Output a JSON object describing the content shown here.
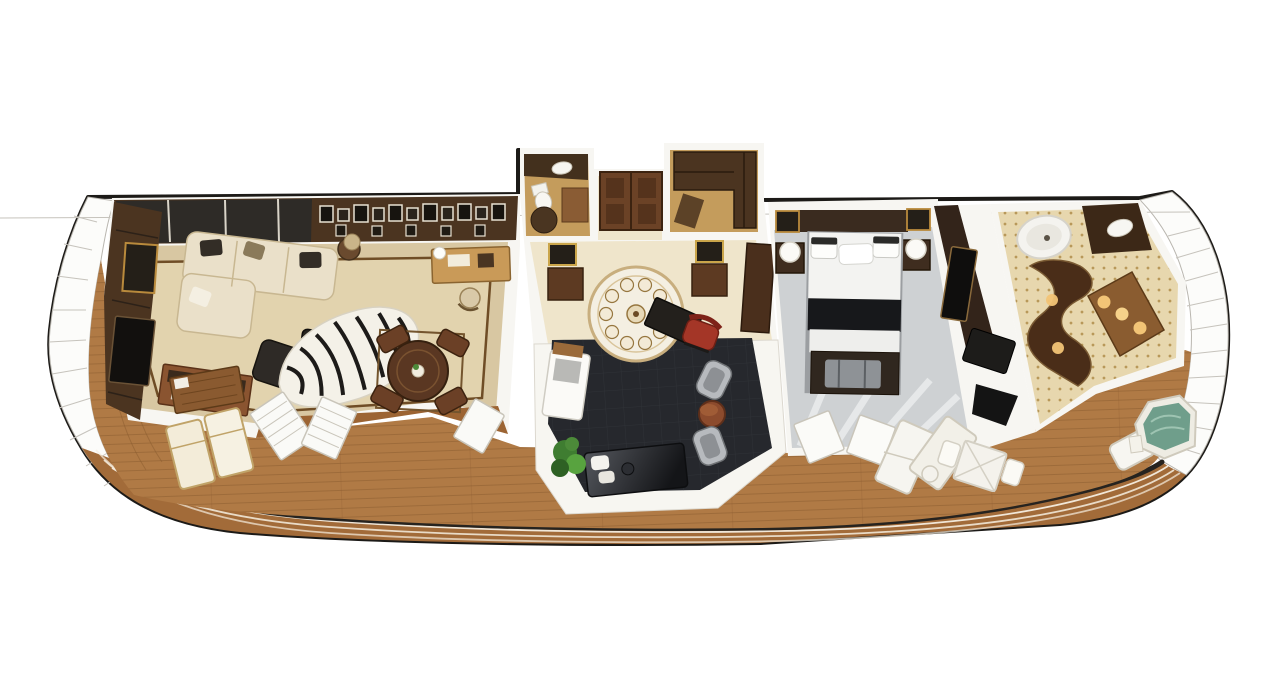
{
  "scene": {
    "type": "3d-floorplan-render",
    "subject": "cruise-ship-suite-aerial-cutaway",
    "rooms": [
      {
        "name": "living-room",
        "furniture": [
          "sectional-sofa",
          "zebra-rug",
          "ottoman",
          "armchair",
          "round-dining-table",
          "dining-chairs",
          "writing-desk",
          "desk-chair",
          "sideboard",
          "tv-cabinet",
          "gallery-wall"
        ]
      },
      {
        "name": "powder-room",
        "furniture": [
          "toilet",
          "vanity",
          "round-table"
        ]
      },
      {
        "name": "entry-foyer",
        "furniture": [
          "double-door",
          "marble-medallion",
          "console-table-left",
          "console-table-right",
          "wardrobe"
        ]
      },
      {
        "name": "walk-in-closet",
        "furniture": [
          "l-shaped-wardrobe"
        ]
      },
      {
        "name": "study-lounge",
        "furniture": [
          "desk",
          "red-chair",
          "silver-armchair",
          "silver-armchair",
          "drum-side-table",
          "daybed",
          "plant",
          "white-console"
        ]
      },
      {
        "name": "bedroom",
        "furniture": [
          "king-bed",
          "nightstand-left",
          "nightstand-right",
          "sphere-lamp-left",
          "sphere-lamp-right",
          "foot-bench",
          "tv-panel",
          "vanity-desk"
        ]
      },
      {
        "name": "master-bathroom",
        "furniture": [
          "round-shower",
          "curved-tub-surround",
          "lit-vanity",
          "vessel-sink"
        ]
      },
      {
        "name": "balcony",
        "furniture": [
          "teak-deck",
          "loungers-left",
          "wood-table",
          "loungers-right",
          "outdoor-dining-table",
          "deck-chair",
          "hot-tub"
        ]
      }
    ]
  },
  "colors": {
    "background": "#ffffff",
    "outline": "#1c1a17",
    "windscreen": "#fcfcfa",
    "windscreen_line": "#c6c3bc",
    "deck": "#b07a45",
    "deck_plank": "#8a5c2f",
    "hull_strip": "#a26b39",
    "rail": "#26231f",
    "wall": "#f7f6f2",
    "living_carpet": "#d8c7a2",
    "living_border": "#6f4d26",
    "wood_floor": "#9c6433",
    "wall_wood": "#4b3420",
    "glass": "#2e2b27",
    "sofa": "#eae0c9",
    "zebra_base": "#f4f1e8",
    "zebra_stripe": "#1d1b19",
    "dining_wood": "#5a3722",
    "foyer_floor": "#efe5cb",
    "study_carpet": "#26282d",
    "platform": "#f7f6f1",
    "red_chair": "#a43627",
    "silver_chair": "#b7babe",
    "daybed": "#1b1c1f",
    "plant": "#4c8a39",
    "bedroom_floor": "#ced1d3",
    "bed_black": "#17181b",
    "bed_white": "#f3f3f1",
    "bath_floor": "#e7d7ae",
    "tub_wood": "#4a2d18",
    "vanity_glow": "#f2c476",
    "tub_water": "#6f9e8b",
    "lounger": "#f3ecd9",
    "table_white": "#f2f0ea"
  }
}
